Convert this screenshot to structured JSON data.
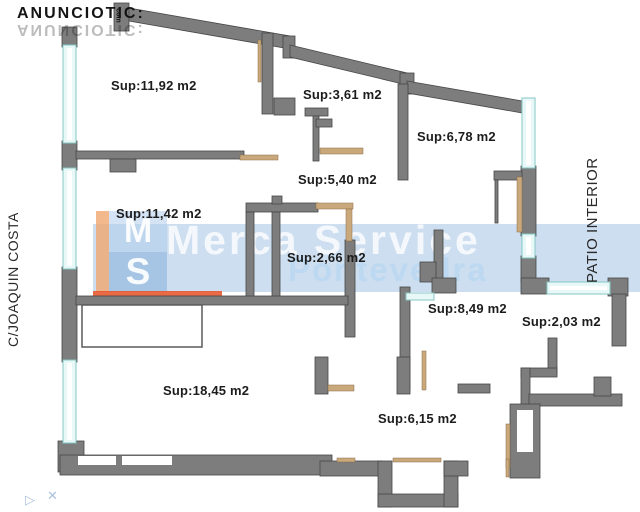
{
  "branding": {
    "logo": {
      "text": "ANUNCIOTIC:",
      "suffix": "com"
    },
    "watermark": {
      "monogram_top": "M",
      "monogram_bottom": "S",
      "line1": "Merca  Service",
      "line2": "Pontevedra"
    }
  },
  "plan": {
    "street_label": "C/JOAQUIN COSTA",
    "patio_label": "PATIO INTERIOR",
    "rooms": [
      {
        "name": "room-11-92",
        "label": "Sup:11,92 m2"
      },
      {
        "name": "room-3-61",
        "label": "Sup:3,61 m2"
      },
      {
        "name": "room-6-78",
        "label": "Sup:6,78 m2"
      },
      {
        "name": "room-5-40",
        "label": "Sup:5,40 m2"
      },
      {
        "name": "room-11-42",
        "label": "Sup:11,42 m2"
      },
      {
        "name": "room-2-66",
        "label": "Sup:2,66 m2"
      },
      {
        "name": "room-8-49",
        "label": "Sup:8,49 m2"
      },
      {
        "name": "room-2-03",
        "label": "Sup:2,03 m2"
      },
      {
        "name": "room-18-45",
        "label": "Sup:18,45 m2"
      },
      {
        "name": "room-6-15",
        "label": "Sup:6,15 m2"
      }
    ],
    "decoration_glyphs": {
      "left": "▷",
      "right": "✕"
    }
  },
  "colors": {
    "wall": "#7d7d7d",
    "wall_stroke": "#474747",
    "window_fill": "#e7f8f7",
    "window_edge": "#87c7c5",
    "door": "#c9a97c",
    "watermark_band": "#80acd6",
    "watermark_accent": "#e65026",
    "label_text": "#1c1c1c"
  }
}
